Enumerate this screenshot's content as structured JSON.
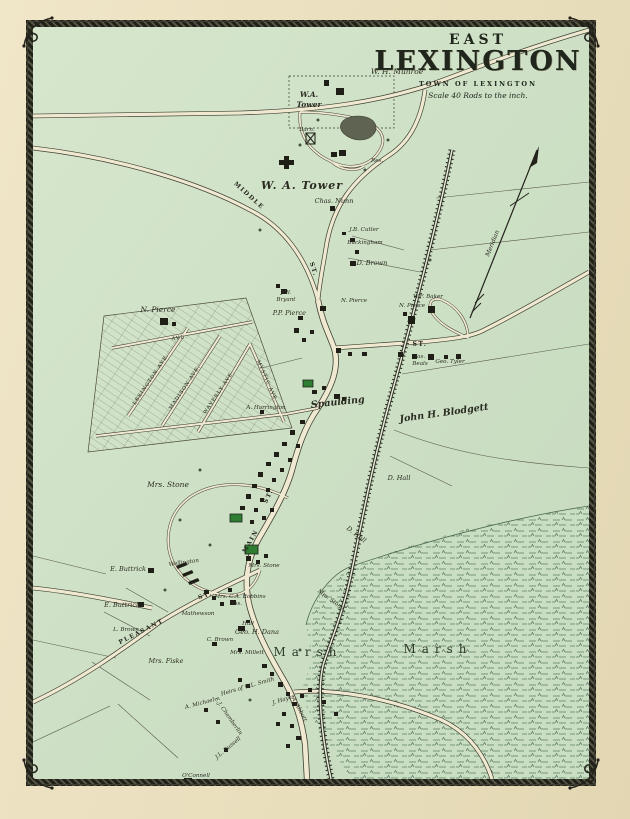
{
  "title": {
    "kicker": "EAST",
    "name": "LEXINGTON",
    "subtitle": "TOWN OF LEXINGTON",
    "scale_note": "Scale 40 Rods to the inch."
  },
  "compass": {
    "label": "Meridian"
  },
  "streets": {
    "middle": "MIDDLE",
    "middle_abbr": "ST.",
    "main": "MAIN",
    "main_abbr": "ST.",
    "pleasant": "PLEASANT",
    "pleasant_abbr": "ST.",
    "cross_abbr": "ST.",
    "lexington_ave": "LEXINGTON AVE.",
    "madison_ave": "MADISON AVE.",
    "waverly_ave": "WAVERLY AVE.",
    "mystic_ave": "MYSTIC AVE.",
    "cross_ave": "AVE."
  },
  "features": {
    "barn": "Barn.",
    "res": "Res.",
    "marsh_west": "Marsh",
    "marsh_east": "Marsh"
  },
  "owners": {
    "munroe": "W. H. Munroe",
    "tower_estate_line1": "W.A.",
    "tower_estate_line2": "Tower",
    "tower": "W. A. Tower",
    "nunn": "Chas. Nunn",
    "bryant_line1": "J.W.",
    "bryant_line2": "Bryant",
    "cutler": "J.B. Cutler",
    "buckingham": "Buckingham",
    "brown_d": "D. Brown",
    "pierce_n_grid": "N. Pierce",
    "pierce_pp": "P.P. Pierce",
    "pierce_n_small": "N. Pierce",
    "pierce_n_east": "N. Pierce",
    "baker": "W.F. Baker",
    "beals_line1": "Jas.",
    "beals_line2": "Beals",
    "tyler": "Geo. Tyler",
    "harrington": "A. Harrington",
    "spaulding": "Spaulding",
    "blodgett": "John H. Blodgett",
    "hall_d_upper": "D. Hall",
    "hall_d_lower": "D. Hall",
    "stone_w": "Mrs. Stone",
    "stone_village": "Mrs. Stone",
    "stone_rr": "Mrs. Stone",
    "buttrick_upper": "E. Buttrick",
    "buttrick_lower": "E. Buttrick",
    "wellington": "Wellington",
    "brown_l": "L. Brown",
    "mathewson": "Mathewson",
    "brown_c": "C. Brown",
    "fiske": "Mrs. Fiske",
    "robbins_line1": "Mrs. C.A. Robbins",
    "robbins_line2": "Res.",
    "dana": "Geo. H. Dana",
    "hall_small": "Hall",
    "millett": "Mrs. Millett",
    "smith": "Heirs of W.L. Smith",
    "hayes": "J. Hayes",
    "abbott": "A. Abbott",
    "michael": "A. Michael",
    "chamberlin": "E.J. Chamberlin",
    "russell": "J.L. Russell",
    "oconnell": "O'Connell"
  },
  "colors": {
    "paper": "#ebe1c0",
    "map_ground": "#cfe2c7",
    "ink": "#2b2b21",
    "road_fill": "#f0e9d1",
    "building": "#1f1f18",
    "public_building_green": "#2e7d33",
    "pond": "#5f6351",
    "marsh_line": "#567a5c",
    "border_band": "#26261e"
  }
}
